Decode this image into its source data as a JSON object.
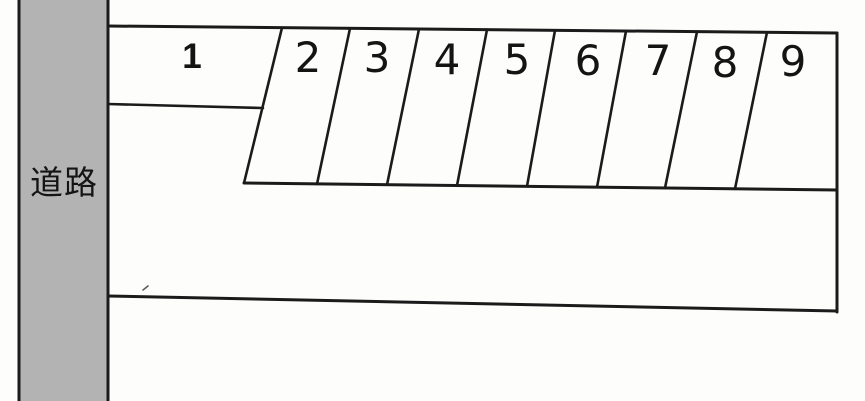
{
  "diagram": {
    "road_label": "道路",
    "stalls": [
      {
        "number": "1"
      },
      {
        "number": "2"
      },
      {
        "number": "3"
      },
      {
        "number": "4"
      },
      {
        "number": "5"
      },
      {
        "number": "6"
      },
      {
        "number": "7"
      },
      {
        "number": "8"
      },
      {
        "number": "9"
      }
    ],
    "colors": {
      "background": "#fdfdfc",
      "road_fill": "#b3b3b3",
      "line": "#1b1b1b",
      "label_text": "#141414"
    }
  }
}
